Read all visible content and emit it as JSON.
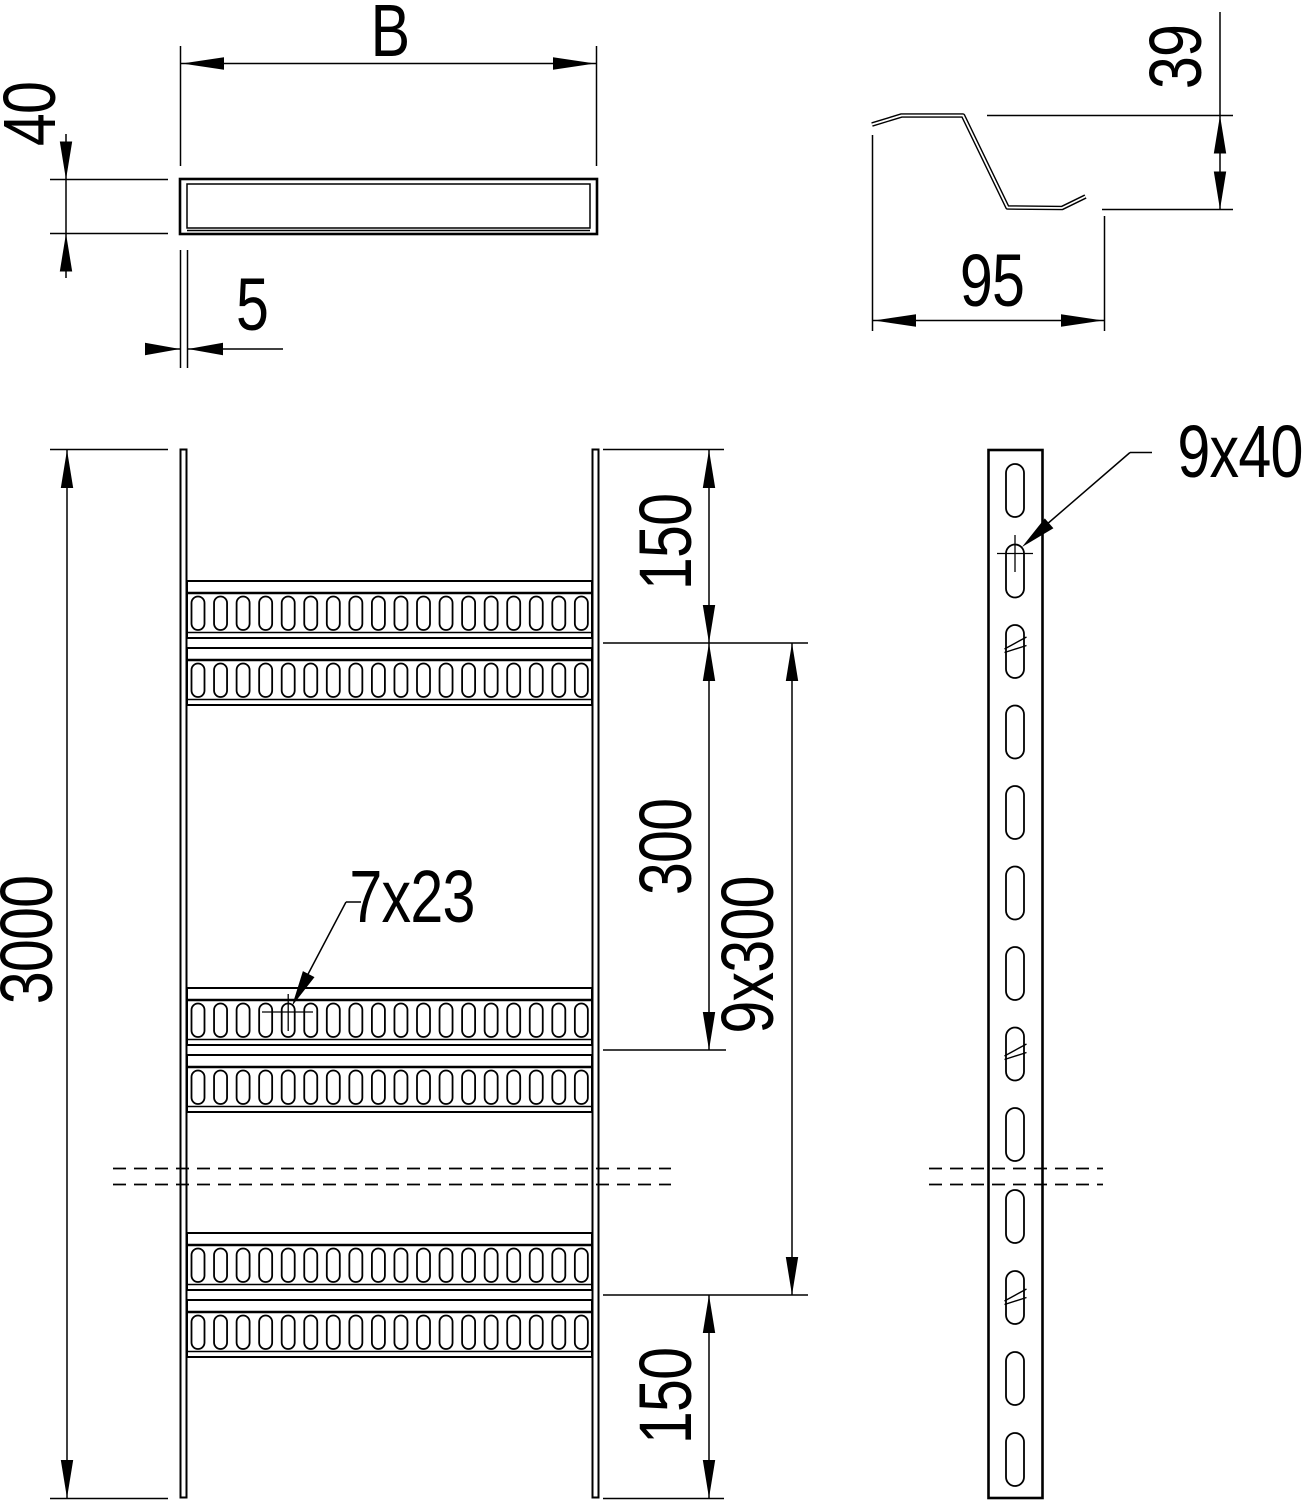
{
  "colors": {
    "background": "#ffffff",
    "line_color": "#000000"
  },
  "views": {
    "rail_end_view": {
      "width_label": "B",
      "height_label": "40",
      "thickness_label": "5"
    },
    "rung_section_view": {
      "height_label": "39",
      "width_label": "95"
    },
    "ladder_front_view": {
      "length_label": "3000",
      "top_spacing_label": "150",
      "rung_pitch_label": "300",
      "total_pitch_label": "9x300",
      "bottom_spacing_label": "150",
      "rung_slot_label": "7x23"
    },
    "rail_side_view": {
      "rail_slot_label": "9x40"
    }
  },
  "geometry": {
    "rungs_visible": 3,
    "bands_per_rung": 2,
    "slots_per_rung_band": 18,
    "side_slots_above_break": 9,
    "side_slots_below_break": 4
  }
}
